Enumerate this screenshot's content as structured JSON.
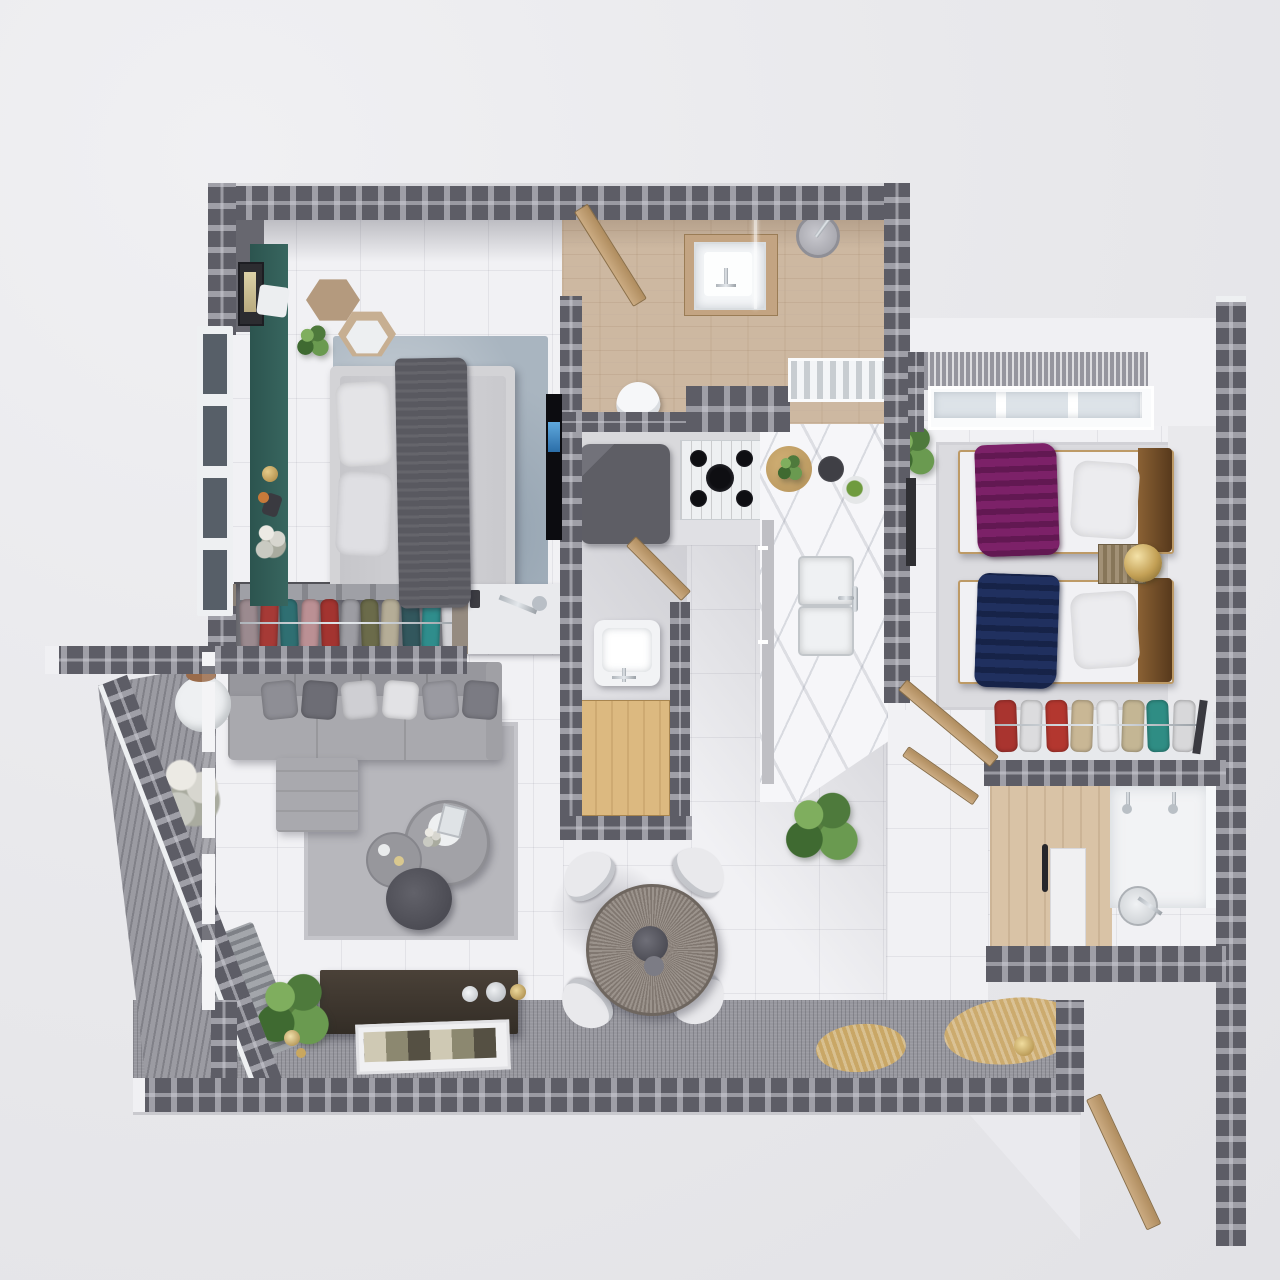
{
  "scene": {
    "type": "3d-floor-plan-render",
    "view": "top-down",
    "description": "Photorealistic top-down 3D render of a two-bedroom apartment floor plan with open living-dining area, kitchen, two bathrooms, wardrobes and a wrap-around balcony terrace",
    "visible_text": ""
  },
  "palette": {
    "background": "#e9e9ec",
    "wall_block": "#84848c",
    "wall_block_dark": "#5d5d66",
    "wall_cap_white": "#f0f0f3",
    "tile_floor": "#f1f1f4",
    "wood_floor": "#cdb8a1",
    "deck": "#97979e",
    "accent_teal_wall": "#33605a",
    "marble_counter": "#f6f6f9",
    "master_rug": "#a9b5c0",
    "living_rug": "#b7b7bc",
    "sofa_gray": "#a9a9ae",
    "throw_purple": "#7c2168",
    "throw_navy": "#20305f",
    "throw_charcoal": "#595960",
    "headboard_bronze": "#8a6134",
    "lamp_gold": "#c3a055",
    "door_wood": "#c1a178",
    "console_darkwood": "#4a4138",
    "dining_table_wood": "#8b8179",
    "terrace_mat_beige": "#c9a766",
    "tv_black": "#0c0c10"
  },
  "rooms": {
    "master_bedroom": {
      "name": "master bedroom",
      "furniture": [
        "double bed",
        "gray duvet",
        "charcoal throw blanket",
        "two pillows",
        "blue-gray area rug",
        "hex side tables",
        "potted plant",
        "wall art frame",
        "teal accent wall",
        "wall TV",
        "dresser desk with lamp",
        "window"
      ]
    },
    "master_wardrobe": {
      "name": "open wardrobe",
      "furniture": [
        "hanging clothes",
        "top shelf stacks",
        "chrome rod"
      ]
    },
    "living_room": {
      "name": "living room",
      "furniture": [
        "L-shaped gray sectional sofa",
        "throw pillows",
        "area rug",
        "nested round coffee tables",
        "dark pouf",
        "flower vase",
        "slatted bench",
        "sheer curtains"
      ]
    },
    "dining_area": {
      "name": "dining area",
      "furniture": [
        "round wood dining table",
        "4 white shell chairs",
        "centerpiece"
      ]
    },
    "kitchen": {
      "name": "kitchen",
      "furniture": [
        "dark fridge",
        "5-burner gas stove",
        "L-shaped marble counter",
        "double sink",
        "cutting board",
        "bowls",
        "potted plant"
      ]
    },
    "main_bathroom": {
      "name": "main bathroom / entry hall",
      "furniture": [
        "wood floor",
        "open wood door",
        "vanity sink",
        "glass divider",
        "shower head",
        "toilet"
      ]
    },
    "powder_room": {
      "name": "powder room / laundry",
      "furniture": [
        "wash basin",
        "wood cabinet",
        "open door"
      ]
    },
    "bedroom_2": {
      "name": "second bedroom",
      "furniture": [
        "twin bed purple throw",
        "twin bed navy throw",
        "white pillows",
        "bronze headboards",
        "slatted nightstand",
        "gold sphere lamp",
        "light rug",
        "window with curtain",
        "corner plant"
      ]
    },
    "wardrobe_2": {
      "name": "second wardrobe",
      "furniture": [
        "hanging clothes",
        "chrome rod"
      ]
    },
    "bathroom_2": {
      "name": "second bathroom",
      "furniture": [
        "wood panel wall",
        "white door",
        "double vanity with faucets",
        "shower set",
        "window strip"
      ]
    },
    "balcony": {
      "name": "balcony terrace",
      "furniture": [
        "slanted parapet wall",
        "round white table",
        "white flower plant",
        "ribbed decking",
        "beige round mats",
        "gold lantern",
        "console sideboard",
        "magazine tray",
        "candles",
        "entrance door"
      ]
    }
  },
  "wardrobe1_clothes": [
    "#9b8a8f",
    "#a63a36",
    "#2f6f72",
    "#bb9094",
    "#a33430",
    "#9d9da3",
    "#6b6b4a",
    "#b5ad97",
    "#32575d",
    "#2f8d8c",
    "#d3d3d7"
  ],
  "wardrobe2_clothes": [
    "#a9342f",
    "#dcdcde",
    "#b3372f",
    "#c9b795",
    "#ededef",
    "#c4b694",
    "#2f8d84",
    "#d8d8da"
  ],
  "sofa_pillow_colors": [
    "#8e8e95",
    "#6d6d75",
    "#cfcfd3",
    "#e2e2e5",
    "#9a9aa1",
    "#7b7b83"
  ],
  "counts": {
    "bedrooms": 2,
    "bathrooms": 2,
    "beds": 3,
    "dining_chairs": 4,
    "wardrobes": 2
  }
}
